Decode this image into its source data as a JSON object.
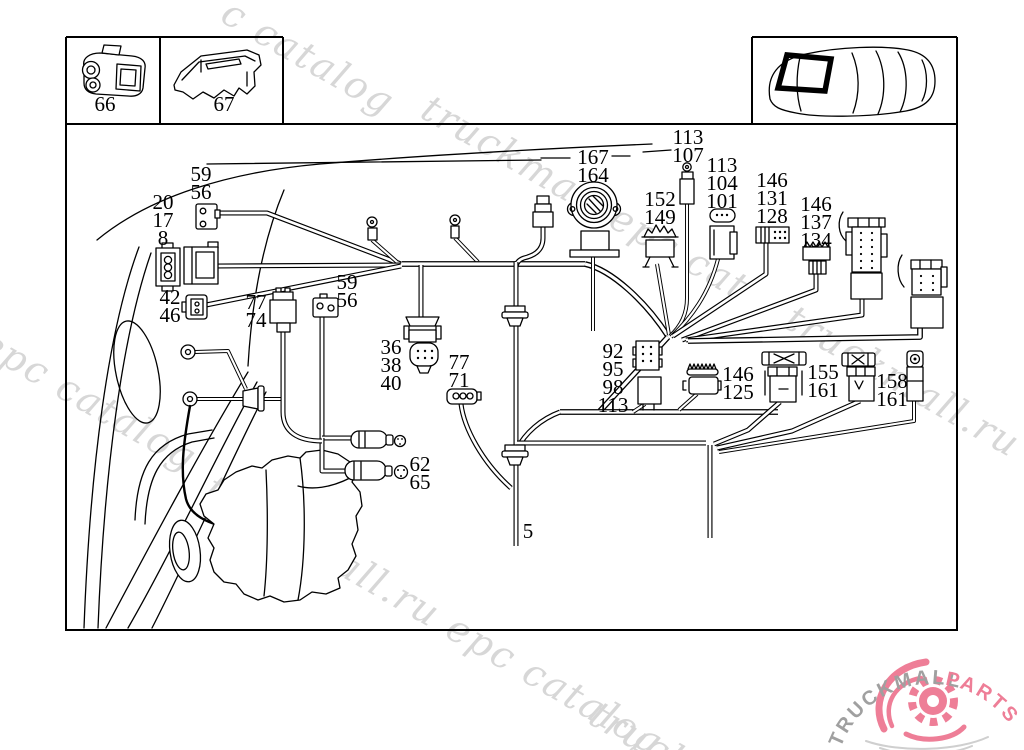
{
  "page": {
    "background": "#ffffff"
  },
  "drawing": {
    "line_color": "#000000"
  },
  "part_labels": [
    {
      "id": "66",
      "x": 105,
      "y": 95,
      "lines": [
        "66"
      ]
    },
    {
      "id": "67",
      "x": 224,
      "y": 95,
      "lines": [
        "67"
      ]
    },
    {
      "id": "113-107",
      "x": 688,
      "y": 128,
      "lines": [
        "113",
        "107"
      ]
    },
    {
      "id": "167-164",
      "x": 593,
      "y": 148,
      "lines": [
        "167",
        "164"
      ]
    },
    {
      "id": "113-104-101",
      "x": 722,
      "y": 156,
      "lines": [
        "113",
        "104",
        "101"
      ]
    },
    {
      "id": "152-149",
      "x": 660,
      "y": 190,
      "lines": [
        "152",
        "149"
      ]
    },
    {
      "id": "146-131-128",
      "x": 772,
      "y": 171,
      "lines": [
        "146",
        "131",
        "128"
      ]
    },
    {
      "id": "146-137-134",
      "x": 816,
      "y": 195,
      "lines": [
        "146",
        "137",
        "134"
      ]
    },
    {
      "id": "59-56-a",
      "x": 201,
      "y": 165,
      "lines": [
        "59",
        "56"
      ]
    },
    {
      "id": "20-17-8",
      "x": 163,
      "y": 193,
      "lines": [
        "20",
        "17",
        "8"
      ]
    },
    {
      "id": "42-46",
      "x": 170,
      "y": 288,
      "lines": [
        "42",
        "46"
      ]
    },
    {
      "id": "77-74",
      "x": 256,
      "y": 293,
      "lines": [
        "77",
        "74"
      ]
    },
    {
      "id": "59-56-b",
      "x": 347,
      "y": 273,
      "lines": [
        "59",
        "56"
      ]
    },
    {
      "id": "36-38-40",
      "x": 391,
      "y": 338,
      "lines": [
        "36",
        "38",
        "40"
      ]
    },
    {
      "id": "77-71",
      "x": 459,
      "y": 353,
      "lines": [
        "77",
        "71"
      ]
    },
    {
      "id": "92-95-98-113",
      "x": 613,
      "y": 342,
      "lines": [
        "92",
        "95",
        "98",
        "113"
      ]
    },
    {
      "id": "146-125",
      "x": 738,
      "y": 365,
      "lines": [
        "146",
        "125"
      ]
    },
    {
      "id": "155-161",
      "x": 823,
      "y": 363,
      "lines": [
        "155",
        "161"
      ]
    },
    {
      "id": "158-161",
      "x": 892,
      "y": 372,
      "lines": [
        "158",
        "161"
      ]
    },
    {
      "id": "62-65",
      "x": 420,
      "y": 455,
      "lines": [
        "62",
        "65"
      ]
    },
    {
      "id": "5",
      "x": 528,
      "y": 522,
      "lines": [
        "5"
      ]
    }
  ],
  "watermarks": {
    "color": "#d7d7d7",
    "items": [
      {
        "text": "c catalog",
        "x": 236,
        "y": -10
      },
      {
        "text": "truckmall epc cat",
        "x": 436,
        "y": 86
      },
      {
        "text": "truckmall.ru e",
        "x": 800,
        "y": 296
      },
      {
        "text": "l epc catalog",
        "x": -30,
        "y": 306
      },
      {
        "text": "truckmall.ru epc catalog",
        "x": 220,
        "y": 466
      },
      {
        "text": "truck",
        "x": 604,
        "y": 692
      }
    ]
  },
  "logo": {
    "brand_gray": "TRUCKMALL",
    "brand_pink": "PARTS",
    "gray_color": "#a0a0a0",
    "pink_color": "#ee7e97"
  }
}
